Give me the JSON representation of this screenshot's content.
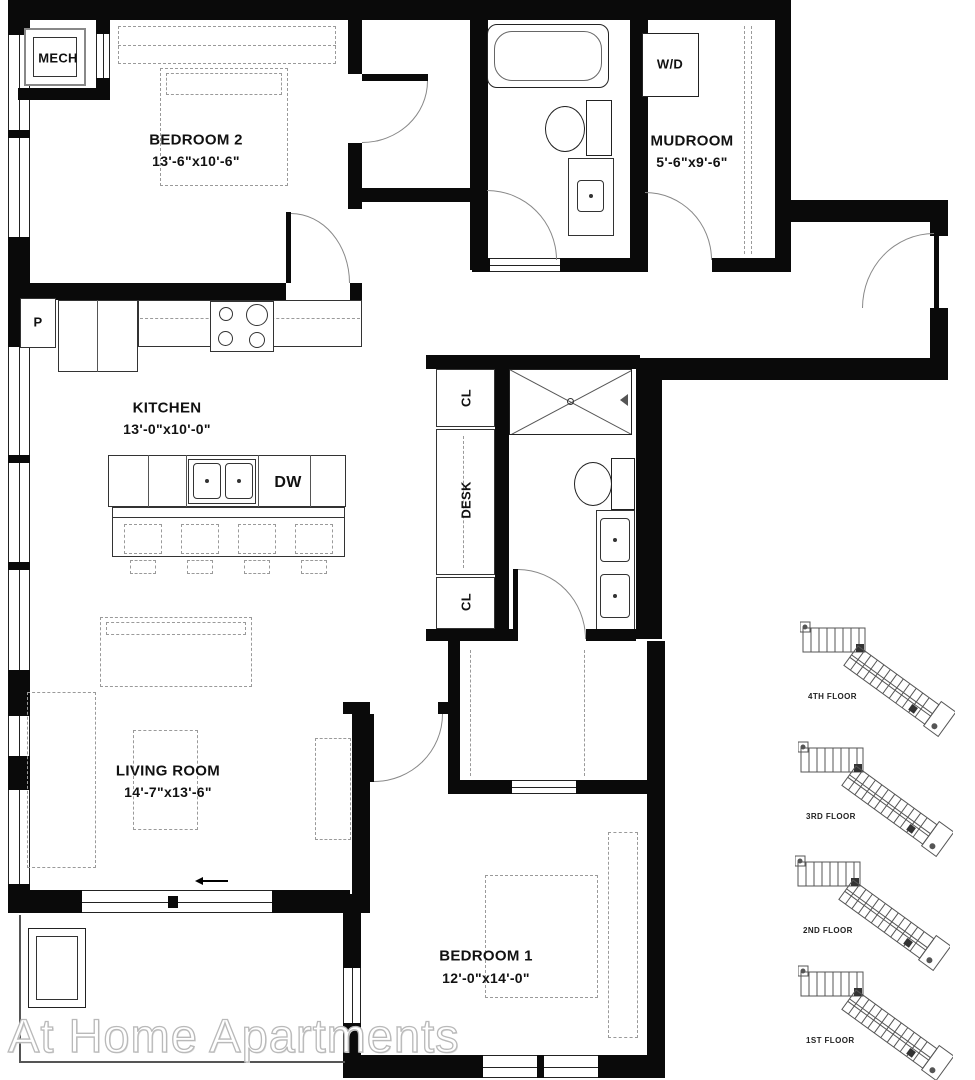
{
  "rooms": {
    "mech": "MECH",
    "bedroom2": {
      "name": "BEDROOM 2",
      "dims": "13'-6\"x10'-6\""
    },
    "mudroom": {
      "name": "MUDROOM",
      "dims": "5'-6\"x9'-6\""
    },
    "kitchen": {
      "name": "KITCHEN",
      "dims": "13'-0\"x10'-0\""
    },
    "living_room": {
      "name": "LIVING ROOM",
      "dims": "14'-7\"x13'-6\""
    },
    "bedroom1": {
      "name": "BEDROOM 1",
      "dims": "12'-0\"x14'-0\""
    }
  },
  "fixtures": {
    "washer_dryer": "W/D",
    "dishwasher": "DW",
    "pantry": "P",
    "closet_upper": "CL",
    "desk": "DESK",
    "closet_lower": "CL"
  },
  "floor_key": {
    "floors": [
      {
        "label": "4TH FLOOR"
      },
      {
        "label": "3RD FLOOR"
      },
      {
        "label": "2ND FLOOR"
      },
      {
        "label": "1ST FLOOR"
      }
    ]
  },
  "watermark": "At Home Apartments",
  "colors": {
    "wall": "#0a0a0a",
    "line": "#555555",
    "dashed": "#9a9a9a",
    "watermark": "#bbbbbb"
  }
}
